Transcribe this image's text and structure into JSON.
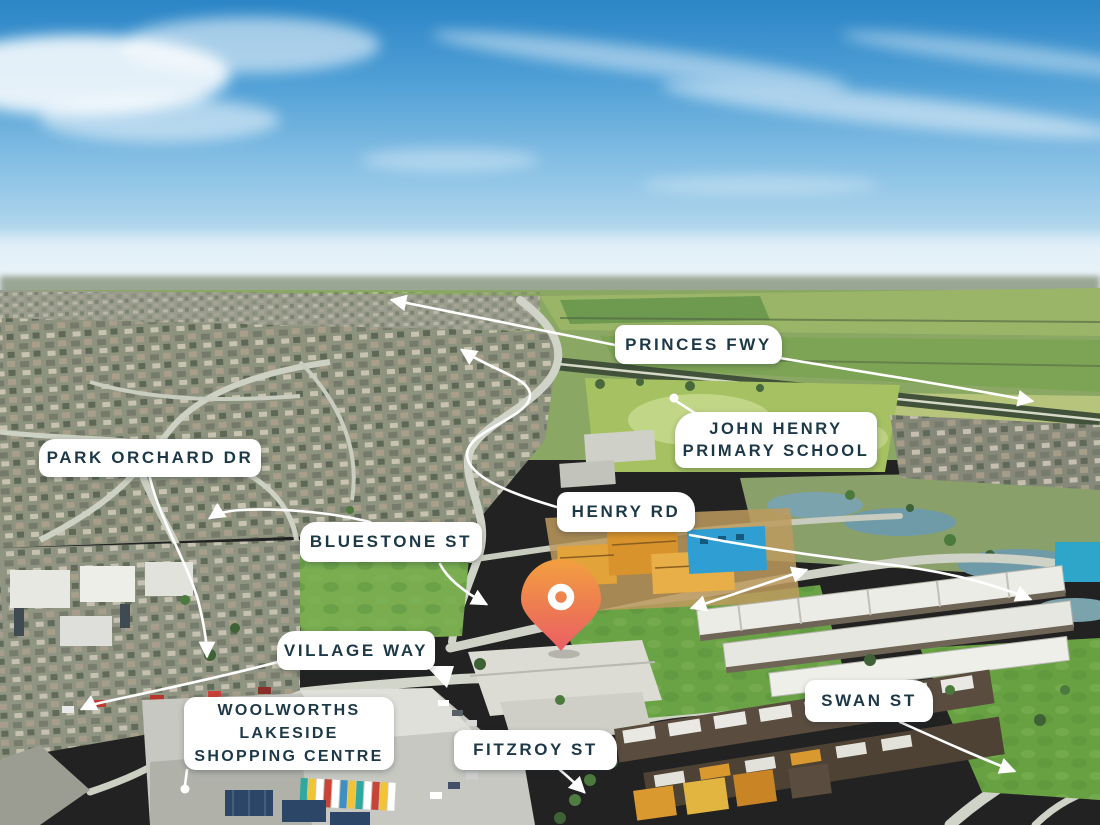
{
  "scene": {
    "type": "aerial-photo-with-street-annotations",
    "marker": {
      "type": "location-pin",
      "color_top": "#F2A03F",
      "color_bottom": "#EA5E66",
      "ring_color": "#FFFFFF"
    },
    "annotation_color": "#FFFFFF",
    "label_bg_color": "#FFFFFF",
    "label_text_color": "#1D3948"
  },
  "labels": {
    "princes_fwy": "PRINCES FWY",
    "john_henry_line1": "JOHN HENRY",
    "john_henry_line2": "PRIMARY SCHOOL",
    "park_orchard_dr": "PARK ORCHARD DR",
    "henry_rd": "HENRY RD",
    "bluestone_st": "BLUESTONE ST",
    "village_way": "VILLAGE WAY",
    "woolworths_line1": "WOOLWORTHS",
    "woolworths_line2": "LAKESIDE",
    "woolworths_line3": "SHOPPING CENTRE",
    "fitzroy_st": "FITZROY ST",
    "swan_st": "SWAN ST"
  }
}
